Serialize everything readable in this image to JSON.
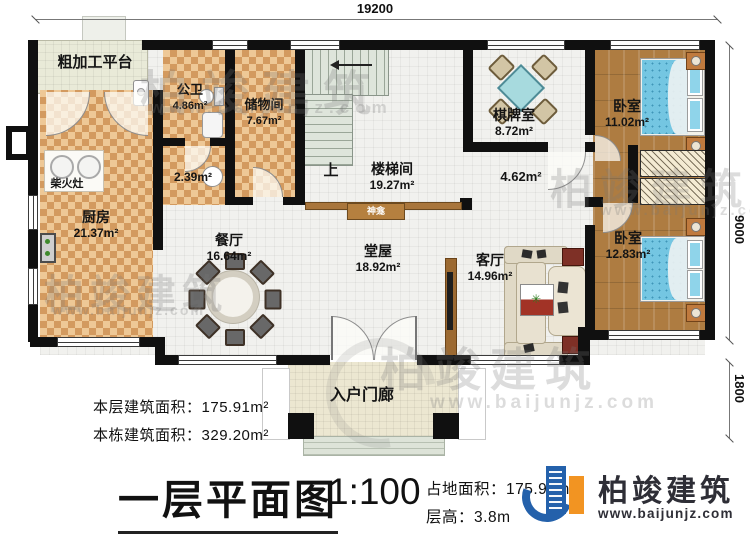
{
  "dimensions": {
    "top": "19200",
    "right_main": "9000",
    "right_porch": "1800"
  },
  "rooms": [
    {
      "name": "粗加工平台",
      "area": ""
    },
    {
      "name": "公卫",
      "area": "4.86m²"
    },
    {
      "name": "储物间",
      "area": "7.67m²"
    },
    {
      "name": "楼梯间",
      "area": "19.27m²"
    },
    {
      "name": "棋牌室",
      "area": "8.72m²"
    },
    {
      "name": "卧室",
      "area": "11.02m²"
    },
    {
      "name": "厨房",
      "area": "21.37m²"
    },
    {
      "name": "餐厅",
      "area": "16.64m²"
    },
    {
      "name": "堂屋",
      "area": "18.92m²"
    },
    {
      "name": "客厅",
      "area": "14.96m²"
    },
    {
      "name": "卧室",
      "area": "12.83m²"
    },
    {
      "name": "入户门廊",
      "area": ""
    }
  ],
  "labels": {
    "stove": "柴火灶",
    "shrine": "神龛",
    "stairs_up": "上",
    "corridor_bath_area": "2.39m²",
    "corridor_bed_area": "4.62m²"
  },
  "stats": {
    "floor_area_label": "本层建筑面积：",
    "floor_area_value": "175.91m²",
    "building_area_label": "本栋建筑面积：",
    "building_area_value": "329.20m²"
  },
  "title_block": {
    "title": "一层平面图",
    "scale": "1:100",
    "site_area_label": "占地面积：",
    "site_area_value": "175.91m²",
    "storey_height_label": "层高：",
    "storey_height_value": "3.8m"
  },
  "brand": {
    "name": "柏竣建筑",
    "website": "www.baijunjz.com"
  },
  "watermark": {
    "name": "柏竣建筑",
    "website": "www.baijunjz.com"
  }
}
